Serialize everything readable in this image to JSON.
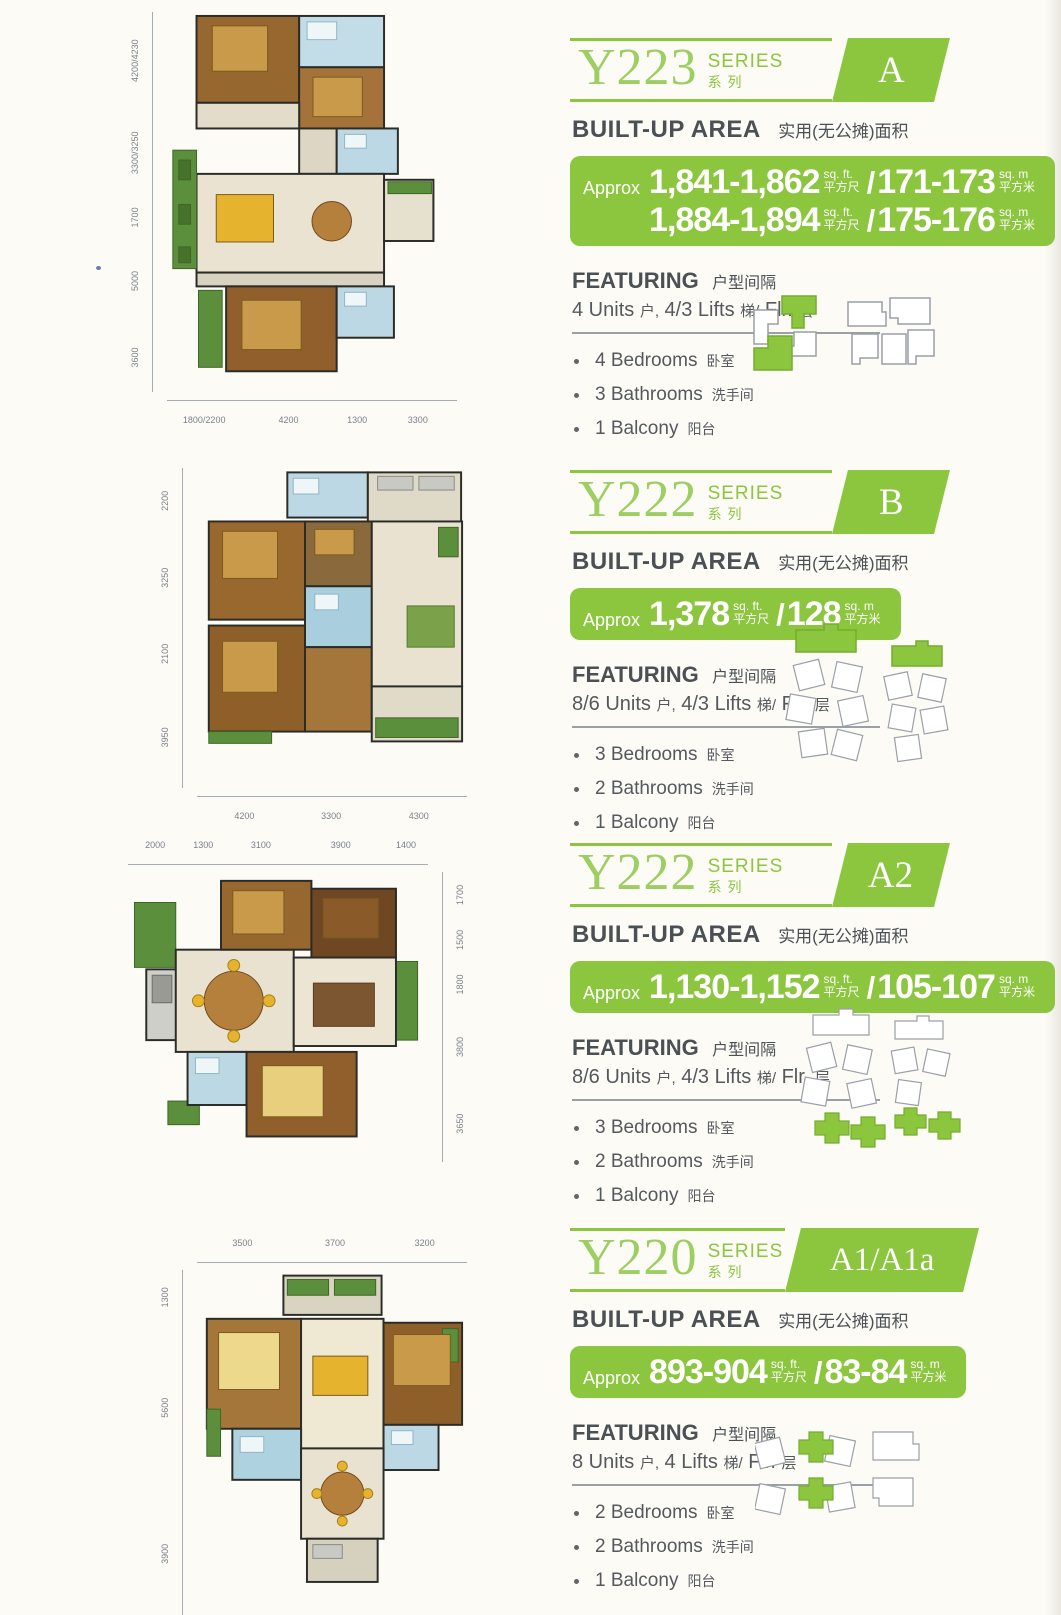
{
  "labels": {
    "series_word": "SERIES",
    "series_cn": "系列",
    "built_up": "BUILT-UP AREA",
    "built_up_cn": "实用(无公摊)面积",
    "approx": "Approx",
    "sqft_unit": "sq. ft.",
    "sqft_cn": "平方尺",
    "sqm_unit": "sq. m",
    "sqm_cn": "平方米",
    "slash": "/",
    "featuring": "FEATURING",
    "featuring_cn": "户型间隔"
  },
  "colors": {
    "accent_green": "#8cc63e",
    "series_text_green": "#9cce62",
    "heading_gray": "#4b5055",
    "body_gray": "#55595e",
    "dim_label_gray": "#7b818a"
  },
  "sections": [
    {
      "series": "Y223",
      "unit": "A",
      "area_lines": [
        {
          "sqft": "1,841-1,862",
          "sqm": "171-173"
        },
        {
          "sqft": "1,884-1,894",
          "sqm": "175-176"
        }
      ],
      "featuring": {
        "units": "4 Units",
        "units_cn": "户,",
        "lifts": "4/3 Lifts",
        "lifts_cn": "梯/",
        "flr": "Flr.",
        "flr_cn": "层"
      },
      "features": [
        {
          "en": "4 Bedrooms",
          "cn": "卧室"
        },
        {
          "en": "3 Bathrooms",
          "cn": "洗手间"
        },
        {
          "en": "1 Balcony",
          "cn": "阳台"
        }
      ],
      "plan": {
        "left_dims": [
          "4200/4230",
          "3300/3250",
          "1700",
          "5000",
          "3600"
        ],
        "bottom_dims": [
          "1800/2200",
          "4200",
          "1300",
          "3300"
        ]
      }
    },
    {
      "series": "Y222",
      "unit": "B",
      "area_lines": [
        {
          "sqft": "1,378",
          "sqm": "128"
        }
      ],
      "featuring": {
        "units": "8/6 Units",
        "units_cn": "户,",
        "lifts": "4/3 Lifts",
        "lifts_cn": "梯/",
        "flr": "Flr.",
        "flr_cn": "层"
      },
      "features": [
        {
          "en": "3 Bedrooms",
          "cn": "卧室"
        },
        {
          "en": "2 Bathrooms",
          "cn": "洗手间"
        },
        {
          "en": "1 Balcony",
          "cn": "阳台"
        }
      ],
      "plan": {
        "left_dims": [
          "2200",
          "3250",
          "2100",
          "3950"
        ],
        "bottom_dims": [
          "4200",
          "3300",
          "4300"
        ]
      }
    },
    {
      "series": "Y222",
      "unit": "A2",
      "area_lines": [
        {
          "sqft": "1,130-1,152",
          "sqm": "105-107"
        }
      ],
      "featuring": {
        "units": "8/6 Units",
        "units_cn": "户,",
        "lifts": "4/3 Lifts",
        "lifts_cn": "梯/",
        "flr": "Flr.",
        "flr_cn": "层"
      },
      "features": [
        {
          "en": "3 Bedrooms",
          "cn": "卧室"
        },
        {
          "en": "2 Bathrooms",
          "cn": "洗手间"
        },
        {
          "en": "1 Balcony",
          "cn": "阳台"
        }
      ],
      "plan": {
        "top_dims": [
          "2000",
          "1300",
          "3100",
          "3900",
          "1400"
        ],
        "right_dims": [
          "1700",
          "1500",
          "1800",
          "3800",
          "3650"
        ]
      }
    },
    {
      "series": "Y220",
      "unit": "A1/A1a",
      "area_lines": [
        {
          "sqft": "893-904",
          "sqm": "83-84"
        }
      ],
      "featuring": {
        "units": "8 Units",
        "units_cn": "户,",
        "lifts": "4 Lifts",
        "lifts_cn": "梯/",
        "flr": "Flr.",
        "flr_cn": "层"
      },
      "features": [
        {
          "en": "2 Bedrooms",
          "cn": "卧室"
        },
        {
          "en": "2 Bathrooms",
          "cn": "洗手间"
        },
        {
          "en": "1 Balcony",
          "cn": "阳台"
        }
      ],
      "plan": {
        "top_dims": [
          "3500",
          "3700",
          "3200"
        ],
        "left_dims": [
          "1300",
          "5600",
          "3900"
        ]
      }
    }
  ]
}
